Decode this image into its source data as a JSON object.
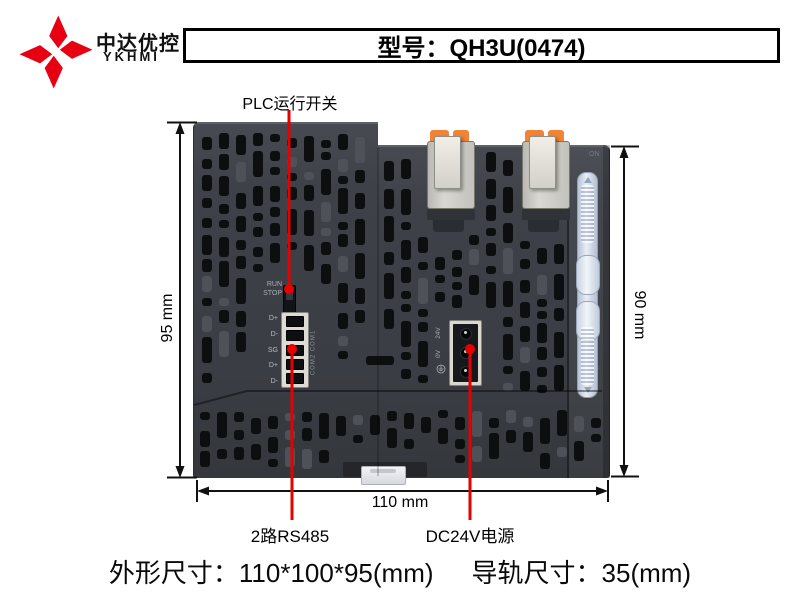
{
  "brand": {
    "name_cn": "中达优控",
    "name_en": "YKHMI"
  },
  "header": {
    "model_label": "型号：QH3U(0474)"
  },
  "callouts": {
    "plc_switch": "PLC运行开关",
    "rs485": "2路RS485",
    "power": "DC24V电源"
  },
  "dimensions": {
    "height_left": "95 mm",
    "height_right": "90 mm",
    "width_bottom": "110 mm"
  },
  "device": {
    "run": "RUN",
    "stop": "STOP",
    "rs485_pins": [
      "D+",
      "D-",
      "SG",
      "D+",
      "D-"
    ],
    "com_ports": "COM2 COM1",
    "power_pin_top": "24V",
    "power_pin_mid": "0V",
    "rail_lock_on": "ON",
    "rail_lock_off": "OFF"
  },
  "footer": {
    "outline_size": "外形尺寸：110*100*95(mm)",
    "rail_size": "导轨尺寸：35(mm)"
  },
  "colors": {
    "logo_red": "#e60012",
    "annotation_red": "#e60000",
    "device_body": "#3e4248",
    "vent_dark": "#0d0e10",
    "orange_clip": "#f08334",
    "slider_blue": "#ccd7e6"
  }
}
